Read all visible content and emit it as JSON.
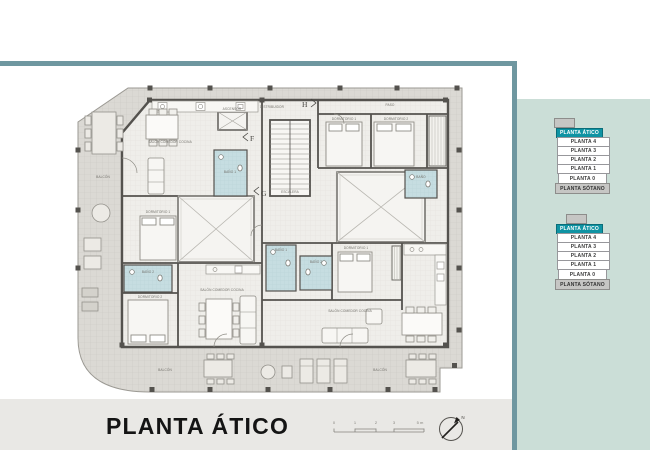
{
  "title_block": {
    "title": "PLANTA ÁTICO"
  },
  "scale_bar": {
    "labels": [
      "0",
      "1",
      "2",
      "3",
      "5 m"
    ]
  },
  "north": {
    "label": "N"
  },
  "colors": {
    "accent_teal": "#0f93a3",
    "frame_teal": "#6f97a0",
    "sidebar_bg": "#cbded7",
    "bath_blue": "#c6dde1",
    "strip_bg": "#e9e8e5"
  },
  "sidebar": {
    "selectors": [
      {
        "floors": [
          {
            "label": "PLANTA ÁTICO",
            "selected": true
          },
          {
            "label": "PLANTA 4"
          },
          {
            "label": "PLANTA 3"
          },
          {
            "label": "PLANTA 2"
          },
          {
            "label": "PLANTA 1"
          },
          {
            "label": "PLANTA 0"
          },
          {
            "label": "PLANTA SÓTANO"
          }
        ]
      },
      {
        "floors": [
          {
            "label": "PLANTA ÁTICO",
            "selected": true
          },
          {
            "label": "PLANTA 4"
          },
          {
            "label": "PLANTA 3"
          },
          {
            "label": "PLANTA 2"
          },
          {
            "label": "PLANTA 1"
          },
          {
            "label": "PLANTA 0"
          },
          {
            "label": "PLANTA SÓTANO"
          }
        ]
      }
    ]
  },
  "plan": {
    "labels": {
      "balcon_left": "BALCÓN",
      "salon_tl": "SALÓN COMEDOR COCINA",
      "dorm_tl": "DORMITORIO 1",
      "bano_tl": "BAÑO 1",
      "ascensor": "ASCENSOR",
      "distribuidor": "DISTRIBUIDOR",
      "escalera": "ESCALERA",
      "paso": "PASO",
      "dorm_tr1": "DORMITORIO 1",
      "dorm_tr2": "DORMITORIO 2",
      "bano_tr": "BAÑO",
      "bano_bl": "BAÑO 2",
      "dorm_bl": "DORMITORIO 2",
      "salon_bl": "SALÓN COMEDOR COCINA",
      "dorm_br": "DORMITORIO 1",
      "bano_br1": "BAÑO 1",
      "bano_br2": "BAÑO 2",
      "salon_br": "SALÓN COMEDOR COCINA",
      "balcon_bl": "BALCÓN",
      "balcon_br": "BALCÓN"
    },
    "section_markers": {
      "f": "F",
      "g": "G",
      "h": "H"
    }
  }
}
